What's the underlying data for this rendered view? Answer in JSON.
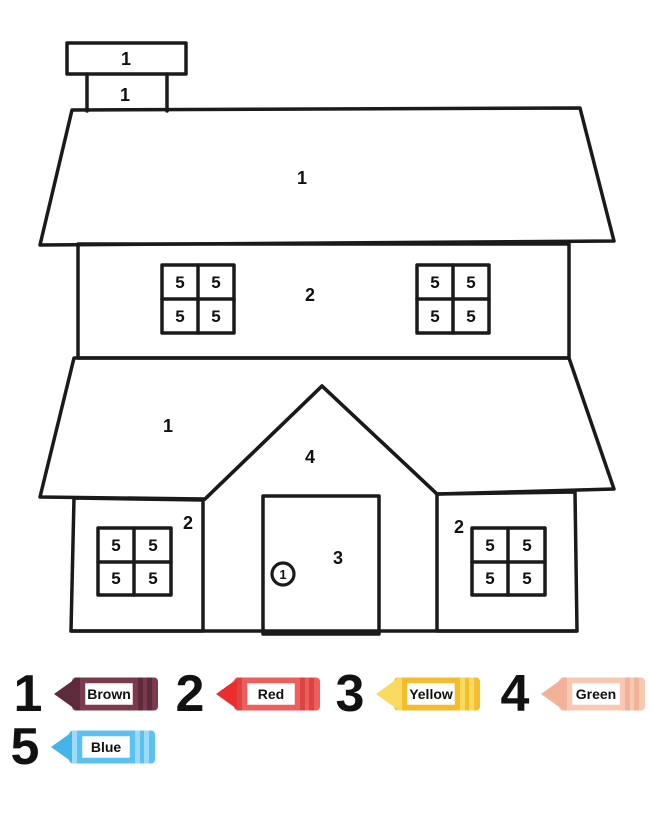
{
  "page": {
    "background": "#ffffff",
    "line_color": "#1a1a1a"
  },
  "house": {
    "chimney_cap_label": "1",
    "chimney_body_label": "1",
    "main_roof_label": "1",
    "second_floor_label": "2",
    "lower_roof_label": "1",
    "gable_label": "4",
    "first_floor_left_label": "2",
    "first_floor_right_label": "2",
    "door_label": "3",
    "doorknob_label": "1",
    "windows": {
      "upper_left": [
        "5",
        "5",
        "5",
        "5"
      ],
      "upper_right": [
        "5",
        "5",
        "5",
        "5"
      ],
      "lower_left": [
        "5",
        "5",
        "5",
        "5"
      ],
      "lower_right": [
        "5",
        "5",
        "5",
        "5"
      ]
    }
  },
  "legend": {
    "entries": [
      {
        "number": "1",
        "color_name": "Brown",
        "body_color": "#7B3B4D",
        "tip_color": "#5D2B3B",
        "ridge_color": "#5D2B3B"
      },
      {
        "number": "2",
        "color_name": "Red",
        "body_color": "#F15C5C",
        "tip_color": "#EC2D2D",
        "ridge_color": "#D94444"
      },
      {
        "number": "3",
        "color_name": "Yellow",
        "body_color": "#F3BD2E",
        "tip_color": "#F9DA60",
        "ridge_color": "#F9DA60"
      },
      {
        "number": "4",
        "color_name": "Green",
        "body_color": "#F8C8B2",
        "tip_color": "#F2B299",
        "ridge_color": "#F2B299"
      },
      {
        "number": "5",
        "color_name": "Blue",
        "body_color": "#5BC1F2",
        "tip_color": "#45B4EA",
        "ridge_color": "#9ED9F6"
      }
    ]
  }
}
